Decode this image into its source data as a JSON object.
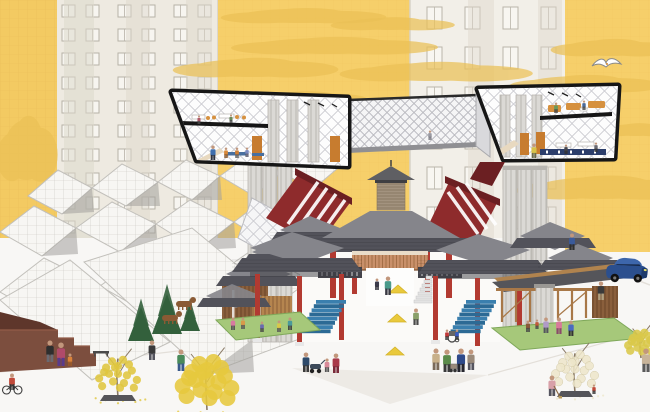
{
  "meta": {
    "title": "Architectural collage illustration: elevated section boxes and lattice bridge over a traditional pavilion plaza, white wireframe roofscape, yellow sky and apartment towers",
    "canvas": {
      "w": 650,
      "h": 412
    }
  },
  "palette": {
    "sky_yellow": "#f6cf6a",
    "strip_yellow": "#f3ca62",
    "cloud_yellow": "#ebc156",
    "facade_a": "#eeeae1",
    "facade_b": "#f2efe8",
    "facade_line": "#b7b2a7",
    "window_fill": "#f7f5f0",
    "shade_band": "#ddd8cc",
    "frame_black": "#161616",
    "diagrid_line": "#c7c7cd",
    "concrete": "#dbd9d5",
    "concrete_line": "#b9b6b1",
    "wire_line": "#c2c0bb",
    "wire_fill": "#f7f6f3",
    "gable_shadow": "#a3a19c",
    "roof_top": "#85858b",
    "roof_face": "#52525a",
    "roof_under": "#3b3b42",
    "red_panel": "#8e2b2c",
    "red_dark": "#6b1f22",
    "red_column": "#b23a31",
    "orange_screen": "#c9906a",
    "orange_screen_line": "#a06b43",
    "door_orange": "#c77c2f",
    "furn_orange": "#d6913f",
    "timber": "#b0834e",
    "timber_dark": "#7c5232",
    "lawn": "#a6c87a",
    "lawn_dark": "#7fa85a",
    "conifer": "#33603c",
    "stair_blue": "#3a7fae",
    "stair_blue_dark": "#2c6a95",
    "bench_blue": "#49709f",
    "ground": "#f8f7f5",
    "ground_tri": "#edeae5",
    "ground_line": "#e3dfd9",
    "steps_brown": "#7c4e3e",
    "steps_dark": "#5e362b",
    "planter": "#55555a",
    "skin": "#c2977c",
    "railing_dark": "#43434a",
    "stair_white": "#e3e3e3",
    "marker_yellow": "#e9c93c",
    "dog_brown": "#8a5a34",
    "car_blue": "#2b4f8e",
    "car_roof": "#3d66ab",
    "car_window": "#182a4a",
    "car_trim": "#1d3a6b",
    "gull_white": "#ffffff",
    "gull_line": "#8a8a8a"
  },
  "scene": {
    "clouds": [
      {
        "x": 300,
        "y": 16,
        "w": 120,
        "h": 14
      },
      {
        "x": 390,
        "y": 24,
        "w": 90,
        "h": 12
      },
      {
        "x": 330,
        "y": 46,
        "w": 150,
        "h": 16
      },
      {
        "x": 252,
        "y": 68,
        "w": 120,
        "h": 18
      },
      {
        "x": 432,
        "y": 72,
        "w": 140,
        "h": 18
      },
      {
        "x": 302,
        "y": 98,
        "w": 90,
        "h": 12
      },
      {
        "x": 610,
        "y": 48,
        "w": 90,
        "h": 16
      },
      {
        "x": 582,
        "y": 84,
        "w": 110,
        "h": 16
      },
      {
        "x": 602,
        "y": 188,
        "w": 130,
        "h": 22
      },
      {
        "x": 636,
        "y": 130,
        "w": 60,
        "h": 12
      },
      {
        "x": 26,
        "y": 150,
        "w": 44,
        "h": 60
      },
      {
        "x": 30,
        "y": 272,
        "w": 48,
        "h": 80
      }
    ],
    "seagull": {
      "x": 606,
      "y": 64
    },
    "car": {
      "x": 607,
      "y": 256,
      "rot": 6
    },
    "markers": [
      {
        "x": 398,
        "y": 289
      },
      {
        "x": 397,
        "y": 318
      },
      {
        "x": 395,
        "y": 351
      }
    ],
    "trees": [
      {
        "x": 118,
        "y": 397,
        "h": 62,
        "c": "#dfc63f",
        "planter": true,
        "sparse": true,
        "fallen": true
      },
      {
        "x": 207,
        "y": 410,
        "h": 80,
        "c": "#e6c83e",
        "dense": true,
        "fallen": true
      },
      {
        "x": 575,
        "y": 393,
        "h": 64,
        "c": "#eee7cb",
        "planter": true,
        "pale": true,
        "fallen": true
      },
      {
        "x": 641,
        "y": 358,
        "h": 42,
        "c": "#d9c84a",
        "dense": true
      }
    ],
    "conifers": [
      {
        "x": 141,
        "y": 341,
        "h": 34,
        "w": 13
      },
      {
        "x": 167,
        "y": 334,
        "h": 40,
        "w": 15
      },
      {
        "x": 190,
        "y": 331,
        "h": 26,
        "w": 10
      }
    ],
    "dogs": [
      {
        "x": 170,
        "y": 322
      },
      {
        "x": 184,
        "y": 308
      }
    ],
    "props": [
      {
        "type": "stroller",
        "x": 316,
        "y": 373
      },
      {
        "type": "cart",
        "x": 453,
        "y": 372
      },
      {
        "type": "wheelchair",
        "x": 452,
        "y": 342
      },
      {
        "type": "bench",
        "x": 101,
        "y": 355
      }
    ],
    "people": [
      {
        "x": 213,
        "y": 160,
        "h": 15,
        "c": "#3f6fae",
        "p": "#2e3340"
      },
      {
        "x": 226,
        "y": 158,
        "h": 11,
        "c": "#d98a3a",
        "p": "#845224"
      },
      {
        "x": 237,
        "y": 158,
        "h": 11,
        "c": "#cf7f35",
        "p": "#5a5a5a"
      },
      {
        "x": 247,
        "y": 157,
        "h": 10,
        "c": "#7a8ac0",
        "p": "#555566"
      },
      {
        "x": 199,
        "y": 124,
        "h": 9,
        "c": "#b05a6a",
        "p": "#4a4a4a"
      },
      {
        "x": 231,
        "y": 123,
        "h": 9,
        "c": "#6a8a5a",
        "p": "#4a4a4a"
      },
      {
        "x": 534,
        "y": 158,
        "h": 15,
        "c": "#d8c34a",
        "p": "#6a6a4a"
      },
      {
        "x": 556,
        "y": 113,
        "h": 11,
        "c": "#6a9a5a",
        "p": "#444444"
      },
      {
        "x": 584,
        "y": 110,
        "h": 10,
        "c": "#4a6a9a",
        "p": "#444444"
      },
      {
        "x": 566,
        "y": 154,
        "h": 10,
        "c": "#46464e",
        "p": "#333333"
      },
      {
        "x": 596,
        "y": 152,
        "h": 10,
        "c": "#6a6a72",
        "p": "#333333"
      },
      {
        "x": 430,
        "y": 140,
        "h": 10,
        "c": "#9a9aa2",
        "p": "#7a7a82"
      },
      {
        "x": 50,
        "y": 362,
        "h": 22,
        "c": "#2e2e2e",
        "p": "#6a6a72"
      },
      {
        "x": 61,
        "y": 366,
        "h": 24,
        "c": "#b04a6a",
        "p": "#5a3a8a"
      },
      {
        "x": 70,
        "y": 366,
        "h": 13,
        "c": "#d9823a",
        "p": "#9a5a28"
      },
      {
        "x": 12,
        "y": 393,
        "h": 17,
        "c": "#c04a3a",
        "p": "#333333",
        "bike": true
      },
      {
        "x": 152,
        "y": 360,
        "h": 20,
        "c": "#3a3a3a",
        "p": "#55555f"
      },
      {
        "x": 181,
        "y": 371,
        "h": 22,
        "c": "#4a8a5a",
        "p": "#3a5a8a"
      },
      {
        "x": 306,
        "y": 372,
        "h": 20,
        "c": "#2e4a6a",
        "p": "#3a3a3a"
      },
      {
        "x": 327,
        "y": 372,
        "h": 14,
        "c": "#d88a9a",
        "p": "#555555"
      },
      {
        "x": 336,
        "y": 373,
        "h": 20,
        "c": "#a83a4a",
        "p": "#7a2a3a"
      },
      {
        "x": 388,
        "y": 295,
        "h": 19,
        "c": "#4a9a8a",
        "p": "#3a3a44"
      },
      {
        "x": 377,
        "y": 290,
        "h": 12,
        "c": "#3a3a4a",
        "p": "#2e2e38"
      },
      {
        "x": 416,
        "y": 325,
        "h": 17,
        "c": "#8aa06a",
        "p": "#4a4a4a"
      },
      {
        "x": 436,
        "y": 370,
        "h": 22,
        "c": "#c8b08a",
        "p": "#7a6a5a"
      },
      {
        "x": 447,
        "y": 372,
        "h": 23,
        "c": "#5a8a4a",
        "p": "#3a3a3a"
      },
      {
        "x": 461,
        "y": 372,
        "h": 24,
        "c": "#2e4a8a",
        "p": "#26262e"
      },
      {
        "x": 471,
        "y": 370,
        "h": 21,
        "c": "#9a8a7a",
        "p": "#55555f"
      },
      {
        "x": 447,
        "y": 340,
        "h": 11,
        "c": "#c03a3a",
        "p": "#333333"
      },
      {
        "x": 457,
        "y": 340,
        "h": 11,
        "c": "#3a5ac0",
        "p": "#333333"
      },
      {
        "x": 528,
        "y": 332,
        "h": 12,
        "c": "#8a5a3a",
        "p": "#444444"
      },
      {
        "x": 546,
        "y": 333,
        "h": 16,
        "c": "#b09ac8",
        "p": "#55555f"
      },
      {
        "x": 559,
        "y": 334,
        "h": 17,
        "c": "#d87a9a",
        "p": "#8a4a6a"
      },
      {
        "x": 571,
        "y": 336,
        "h": 16,
        "c": "#4a6ac0",
        "p": "#333333"
      },
      {
        "x": 537,
        "y": 329,
        "h": 10,
        "c": "#c05a3a",
        "p": "#444444"
      },
      {
        "x": 233,
        "y": 330,
        "h": 13,
        "c": "#d87aa0",
        "p": "#555555"
      },
      {
        "x": 243,
        "y": 329,
        "h": 12,
        "c": "#d89a4a",
        "p": "#555555"
      },
      {
        "x": 262,
        "y": 332,
        "h": 11,
        "c": "#6a6ab0",
        "p": "#444444"
      },
      {
        "x": 279,
        "y": 332,
        "h": 12,
        "c": "#d8c84a",
        "p": "#555555"
      },
      {
        "x": 290,
        "y": 330,
        "h": 13,
        "c": "#4a9a9a",
        "p": "#444444"
      },
      {
        "x": 601,
        "y": 300,
        "h": 19,
        "c": "#3a3a3a",
        "p": "#b0a080"
      },
      {
        "x": 572,
        "y": 250,
        "h": 17,
        "c": "#3a5a9a",
        "p": "#2e2e2e"
      },
      {
        "x": 552,
        "y": 396,
        "h": 21,
        "c": "#d8a0a8",
        "p": "#55555f",
        "broom": true
      },
      {
        "x": 594,
        "y": 394,
        "h": 10,
        "c": "#c04a3a",
        "p": "#333333"
      },
      {
        "x": 646,
        "y": 372,
        "h": 24,
        "c": "#c8b49a",
        "p": "#5a5a5a"
      }
    ]
  }
}
